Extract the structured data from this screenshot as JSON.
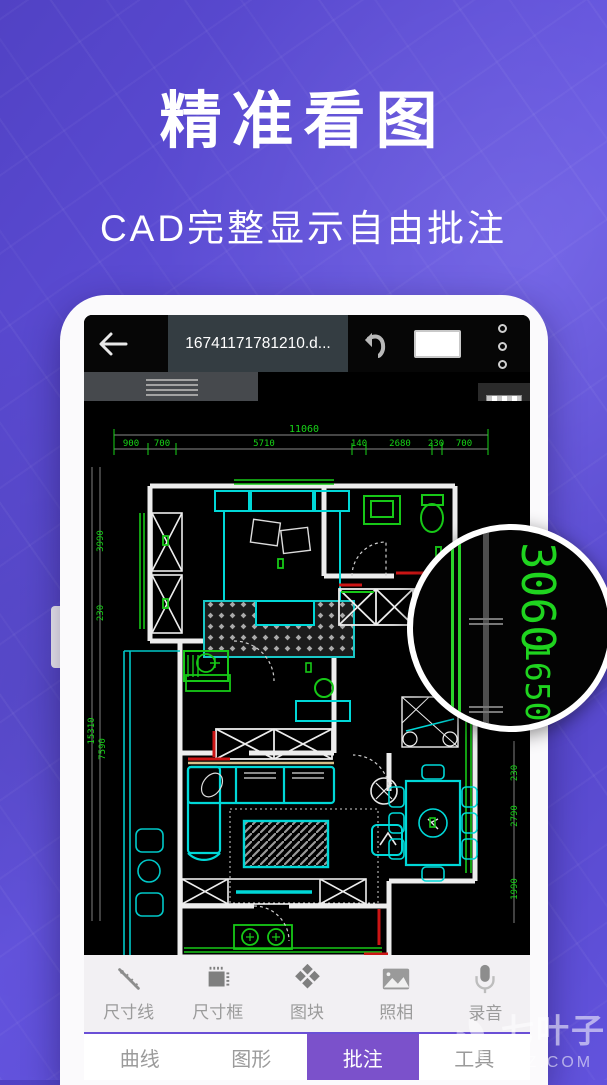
{
  "hero": {
    "title": "精准看图",
    "subtitle": "CAD完整显示自由批注"
  },
  "topbar": {
    "filename": "16741171781210.d..."
  },
  "cad": {
    "dim_total": "11060",
    "dims_top": [
      "900",
      "700",
      "5710",
      "140",
      "2680",
      "230",
      "700"
    ],
    "dims_left": [
      "3990",
      "230",
      "15310",
      "7590"
    ],
    "dims_right": [
      "230",
      "2790",
      "1990"
    ]
  },
  "magnifier": {
    "values": [
      "3060",
      "1650",
      "3190"
    ]
  },
  "toolbar": {
    "items": [
      {
        "icon": "dimension-line-icon",
        "label": "尺寸线"
      },
      {
        "icon": "dimension-box-icon",
        "label": "尺寸框"
      },
      {
        "icon": "block-icon",
        "label": "图块"
      },
      {
        "icon": "camera-icon",
        "label": "照相"
      },
      {
        "icon": "microphone-icon",
        "label": "录音"
      }
    ]
  },
  "tabbar": {
    "tabs": [
      {
        "label": "曲线",
        "active": false
      },
      {
        "label": "图形",
        "active": false
      },
      {
        "label": "批注",
        "active": true
      },
      {
        "label": "工具",
        "active": false
      }
    ]
  },
  "watermark": {
    "name": "七叶子",
    "domain": "7YZ.COM"
  },
  "colors": {
    "accent": "#7b51cb",
    "dim_green": "#17d417",
    "cad_cyan": "#00d8d8",
    "cad_red": "#cc1515",
    "bg_purple": "#5d4dd6"
  }
}
